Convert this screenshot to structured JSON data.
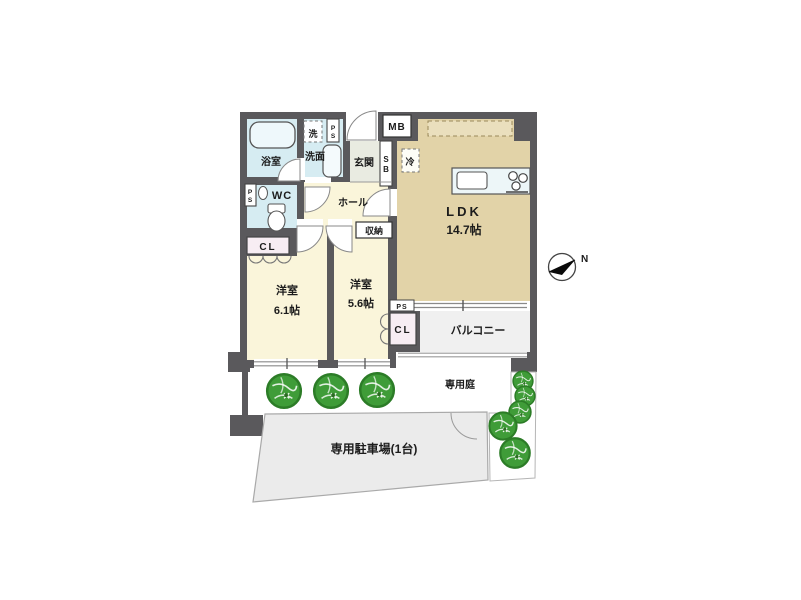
{
  "plan": {
    "rooms": {
      "ldk": {
        "label": "LDK",
        "area": "14.7帖"
      },
      "bedroom_61": {
        "label": "洋室",
        "area": "6.1帖"
      },
      "bedroom_56": {
        "label": "洋室",
        "area": "5.6帖"
      },
      "bath": {
        "label": "浴室"
      },
      "washroom": {
        "label": "洗面"
      },
      "wc": {
        "label": "WC"
      },
      "entrance": {
        "label": "玄関"
      },
      "hall": {
        "label": "ホール"
      },
      "storage": {
        "label": "収納"
      },
      "balcony": {
        "label": "バルコニー"
      }
    },
    "outdoor": {
      "garden": {
        "label": "専用庭"
      },
      "parking": {
        "label": "専用駐車場(1台)"
      }
    },
    "fixtures": {
      "washer": "洗",
      "refrigerator": "冷",
      "meter_box": "MB",
      "shoe_box": "SB",
      "pipe_space": "PS",
      "closet": "CL"
    },
    "compass": {
      "north": "N"
    },
    "colors": {
      "wall": "#5a595c",
      "room": "#faf5da",
      "ldk": "#e2d3a8",
      "wet": "#d6ecf2",
      "closet": "#f7edf3",
      "entrance_floor": "#e9ebe1",
      "balcony": "#f0f0f0",
      "parking": "#ebebeb",
      "tree": "#3f9c38",
      "tree_outline": "#2c7c27"
    }
  }
}
